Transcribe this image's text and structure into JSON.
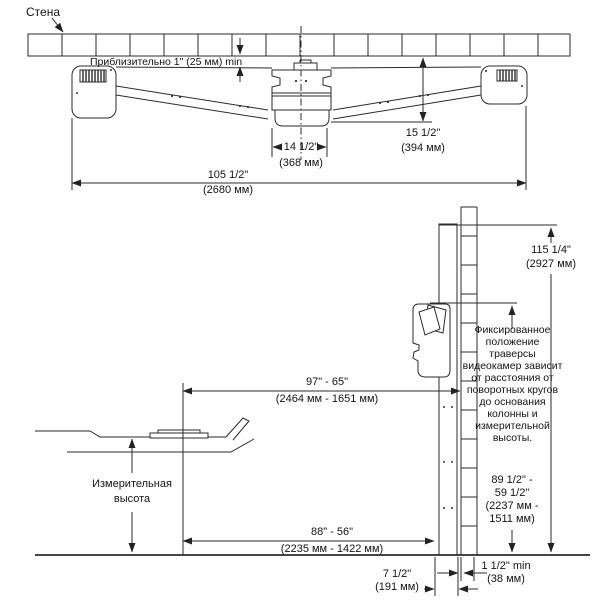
{
  "top_view": {
    "wall_label": "Стена",
    "gap_note": "Приблизительно 1\" (25 мм) min",
    "dim_wall_to_beam_front": "15 1/2\"\n(394 мм)",
    "dim_bracket_width": "14 1/2\"\n(368 мм)",
    "dim_overall_width": "105 1/2\"\n(2680 мм)"
  },
  "side_view": {
    "dim_column_height": "115 1/4\"\n(2927 мм)",
    "camera_note": "Фиксированное положение траверсы видеокамер зависит от расстояния от поворотных кругов до основания колонны и измерительной высоты.",
    "dim_camera_beam_height": "89 1/2\" -\n59 1/2\"\n(2237 мм -\n1511 мм)",
    "dim_turnplate_to_column": "97\" - 65\"\n(2464 мм - 1651 мм)",
    "measuring_height_label": "Измерительная\nвысота",
    "dim_floor_distance": "88\" - 56\"\n(2235 мм - 1422 мм)",
    "dim_column_depth": "7 1/2\"\n(191 мм)",
    "dim_wall_clearance": "1 1/2\" min\n(38 мм)"
  }
}
